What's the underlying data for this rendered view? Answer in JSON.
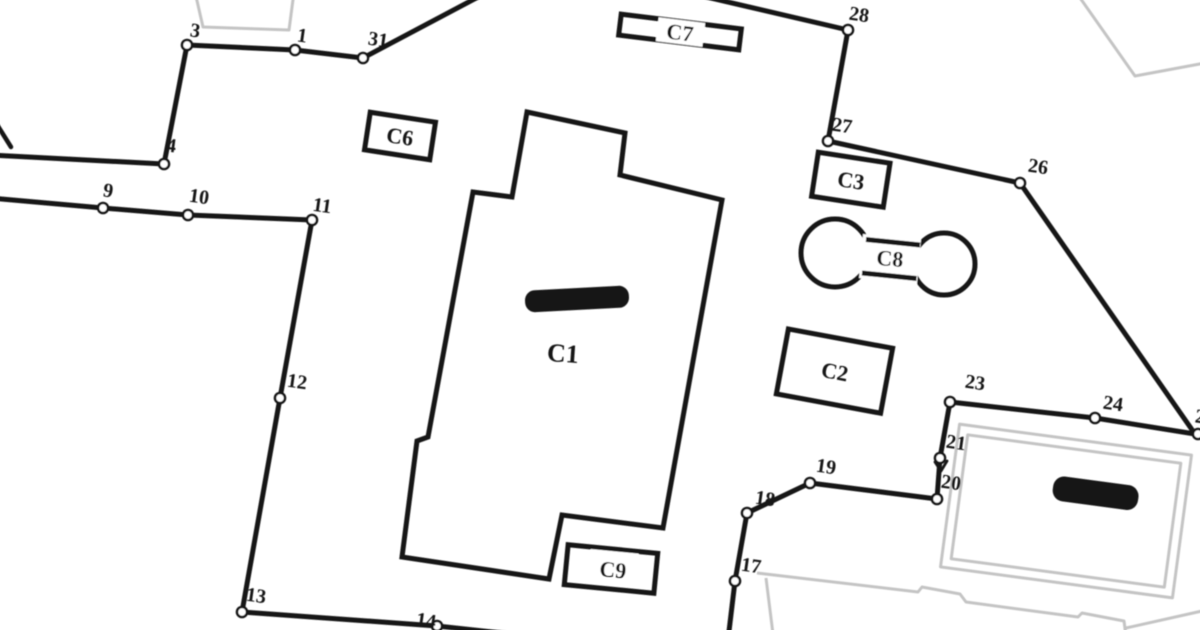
{
  "map": {
    "type": "cadastral-site-plan",
    "palette": {
      "line": "#161616",
      "gray": "#c4c4c4",
      "bg": "#ffffff",
      "marker_fill": "#ffffff"
    },
    "point_labels": {
      "p1": "1",
      "p3": "3",
      "p4": "4",
      "p9": "9",
      "p10": "10",
      "p11": "11",
      "p12": "12",
      "p13": "13",
      "p14": "14",
      "p17": "17",
      "p18": "18",
      "p19": "19",
      "p20": "20",
      "p21": "21",
      "p23": "23",
      "p24": "24",
      "p25_partial": "2",
      "p26": "26",
      "p27": "27",
      "p28": "28",
      "p31": "31"
    },
    "building_labels": {
      "c1": "C1",
      "c2": "C2",
      "c3": "C3",
      "c6": "C6",
      "c7": "C7",
      "c8": "C8",
      "c9": "C9"
    }
  }
}
